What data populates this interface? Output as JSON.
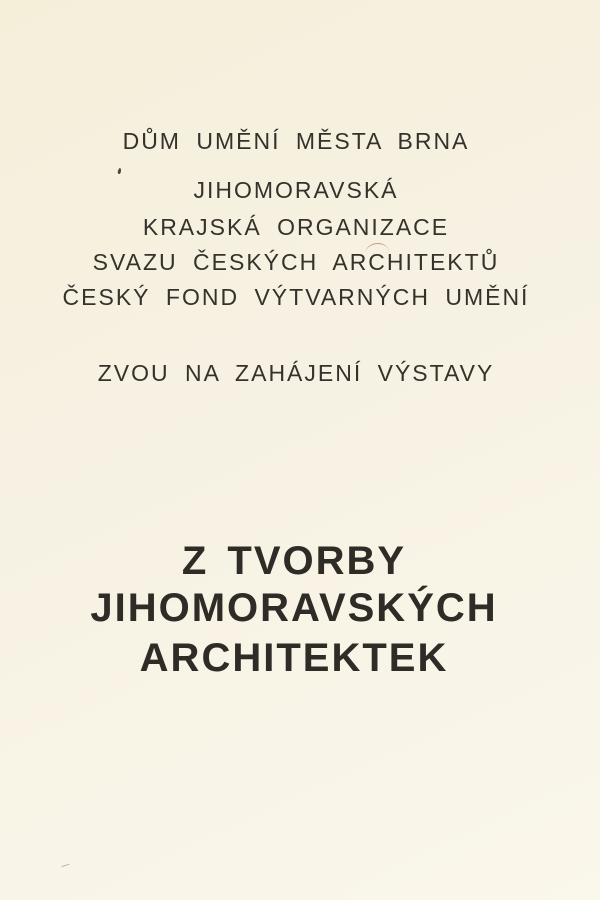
{
  "card": {
    "venue": "DŮM UMĚNÍ MĚSTA BRNA",
    "organizers": [
      "JIHOMORAVSKÁ",
      "KRAJSKÁ ORGANIZACE",
      "SVAZU ČESKÝCH ARCHITEKTŮ",
      "ČESKÝ FOND VÝTVARNÝCH UMĚNÍ"
    ],
    "invitation_line": "ZVOU NA ZAHÁJENÍ VÝSTAVY",
    "exhibition_title_lines": [
      "Z TVORBY",
      "JIHOMORAVSKÝCH",
      "ARCHITEKTEK"
    ],
    "colors": {
      "paper": "#f6f1e1",
      "ink": "#36312b",
      "title_ink": "#2f2b26"
    }
  }
}
